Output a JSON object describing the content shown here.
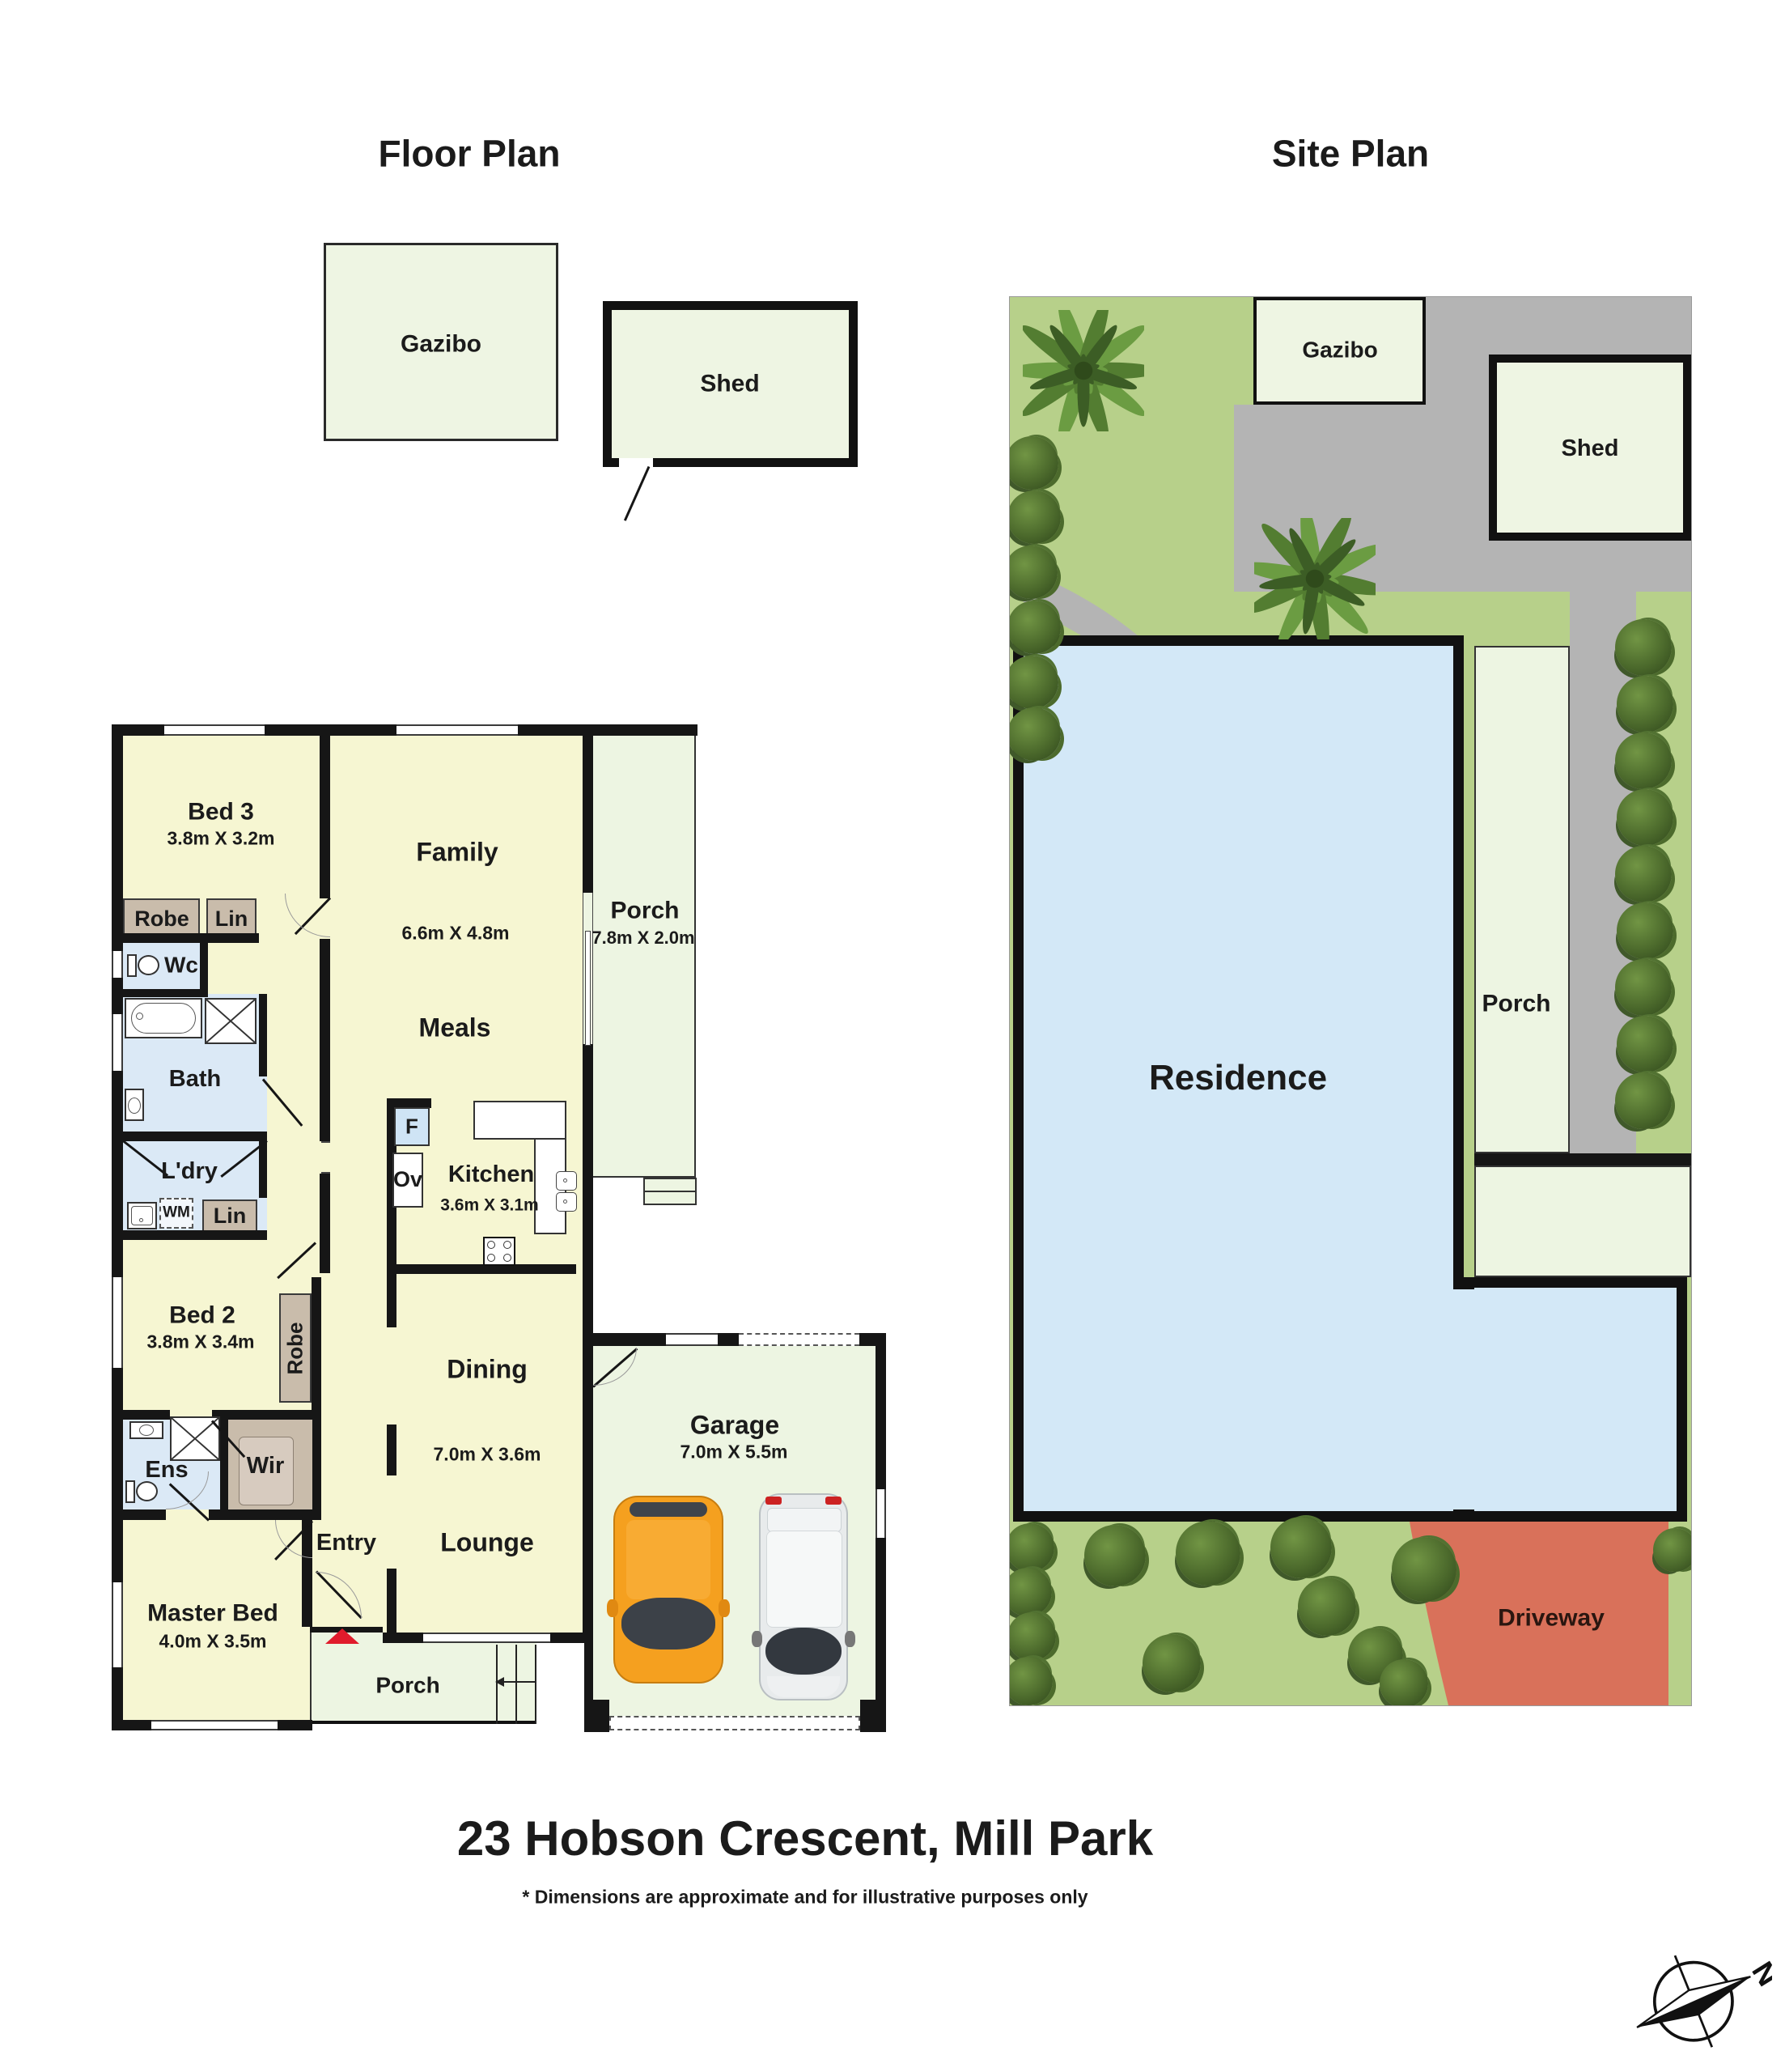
{
  "titles": {
    "floor_plan": "Floor Plan",
    "site_plan": "Site Plan"
  },
  "floor_plan": {
    "outbuildings": {
      "gazibo": "Gazibo",
      "shed": "Shed"
    },
    "rooms": {
      "bed3": {
        "name": "Bed 3",
        "dims": "3.8m X 3.2m"
      },
      "family": {
        "name": "Family",
        "dims": "6.6m X 4.8m"
      },
      "meals": {
        "name": "Meals"
      },
      "porch_rear": {
        "name": "Porch",
        "dims": "7.8m X 2.0m"
      },
      "kitchen": {
        "name": "Kitchen",
        "dims": "3.6m X 3.1m"
      },
      "dining": {
        "name": "Dining"
      },
      "dining_lounge_dims": "7.0m X 3.6m",
      "lounge": {
        "name": "Lounge"
      },
      "bed2": {
        "name": "Bed 2",
        "dims": "3.8m X 3.4m"
      },
      "master_bed": {
        "name": "Master Bed",
        "dims": "4.0m X 3.5m"
      },
      "garage": {
        "name": "Garage",
        "dims": "7.0m X 5.5m"
      },
      "bath": {
        "name": "Bath"
      },
      "wc": {
        "name": "Wc"
      },
      "laundry": {
        "name": "L'dry"
      },
      "ensuite": {
        "name": "Ens"
      },
      "wir": {
        "name": "Wir"
      },
      "entry": {
        "name": "Entry"
      },
      "porch_front": {
        "name": "Porch"
      }
    },
    "storage": {
      "robe_bed3": "Robe",
      "lin_bed3": "Lin",
      "lin_laundry": "Lin",
      "wm": "WM",
      "robe_bed2": "Robe"
    },
    "appliances": {
      "fridge": "F",
      "oven": "Ov"
    }
  },
  "site_plan": {
    "labels": {
      "gazibo": "Gazibo",
      "shed": "Shed",
      "residence": "Residence",
      "porch": "Porch",
      "driveway": "Driveway"
    }
  },
  "footer": {
    "address": "23 Hobson Crescent, Mill Park",
    "disclaimer": "* Dimensions are approximate and for illustrative purposes only"
  },
  "compass": {
    "label": "N"
  },
  "colors": {
    "room_fill": "#f6f6d2",
    "outdoor_fill": "#edf5e2",
    "wet_fill": "#dbe9f6",
    "storage_fill": "#c9bcab",
    "wall": "#161616",
    "grass": "#b7d08a",
    "paving": "#b4b4b4",
    "residence_fill": "#d3e8f7",
    "driveway_fill": "#d9715a",
    "tree": "#46632a",
    "entry_marker": "#e01b2c",
    "car_orange": "#f59d1f",
    "car_white": "#eceff0"
  }
}
